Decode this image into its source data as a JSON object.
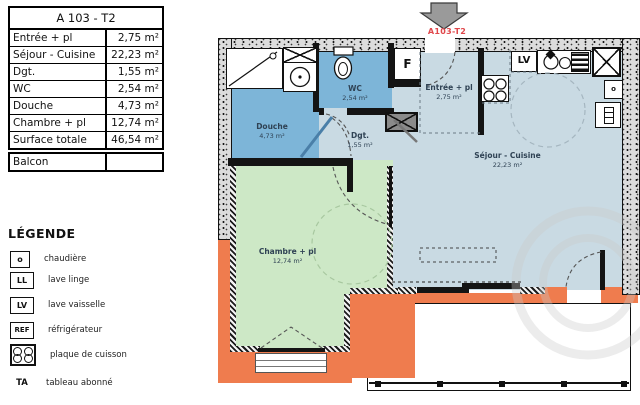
{
  "unit_table": {
    "title": "A 103 - T2",
    "rows": [
      {
        "label": "Entrée + pl",
        "value": "2,75 m²"
      },
      {
        "label": "Séjour - Cuisine",
        "value": "22,23 m²"
      },
      {
        "label": "Dgt.",
        "value": "1,55 m²"
      },
      {
        "label": "WC",
        "value": "2,54 m²"
      },
      {
        "label": "Douche",
        "value": "4,73 m²"
      },
      {
        "label": "Chambre + pl",
        "value": "12,74 m²"
      },
      {
        "label": "Surface totale",
        "value": "46,54 m²"
      }
    ]
  },
  "balcony_row": {
    "label": "Balcon",
    "value": ""
  },
  "legend": {
    "title": "LÉGENDE",
    "items": [
      {
        "symbol": "o",
        "label": "chaudière"
      },
      {
        "symbol": "LL",
        "label": "lave linge"
      },
      {
        "symbol": "LV",
        "label": "lave vaisselle"
      },
      {
        "symbol": "REF",
        "label": "réfrigérateur"
      },
      {
        "symbol": "cooktop-icon",
        "label": "plaque de cuisson"
      },
      {
        "symbol": "TA",
        "label": "tableau abonné"
      }
    ]
  },
  "plan": {
    "unit_label": "A103-T2",
    "rooms": {
      "douche": {
        "name": "Douche",
        "area": "4,73 m²"
      },
      "wc": {
        "name": "WC",
        "area": "2,54 m²"
      },
      "dgt": {
        "name": "Dgt.",
        "area": "1,55 m²"
      },
      "entree": {
        "name": "Entrée + pl",
        "area": "2,75 m²"
      },
      "sejour": {
        "name": "Séjour - Cuisine",
        "area": "22,23 m²"
      },
      "chambre": {
        "name": "Chambre + pl",
        "area": "12,74 m²"
      }
    },
    "fixtures": {
      "dishwasher_label": "LV",
      "entry_box_label": "F",
      "boiler_label": "o"
    },
    "colors": {
      "wall_orange": "#ef7c4e",
      "room_blue": "#7db5d8",
      "room_lightblue": "#c9dae3",
      "room_green": "#cde8c6",
      "accent_red": "#e0474b"
    }
  }
}
